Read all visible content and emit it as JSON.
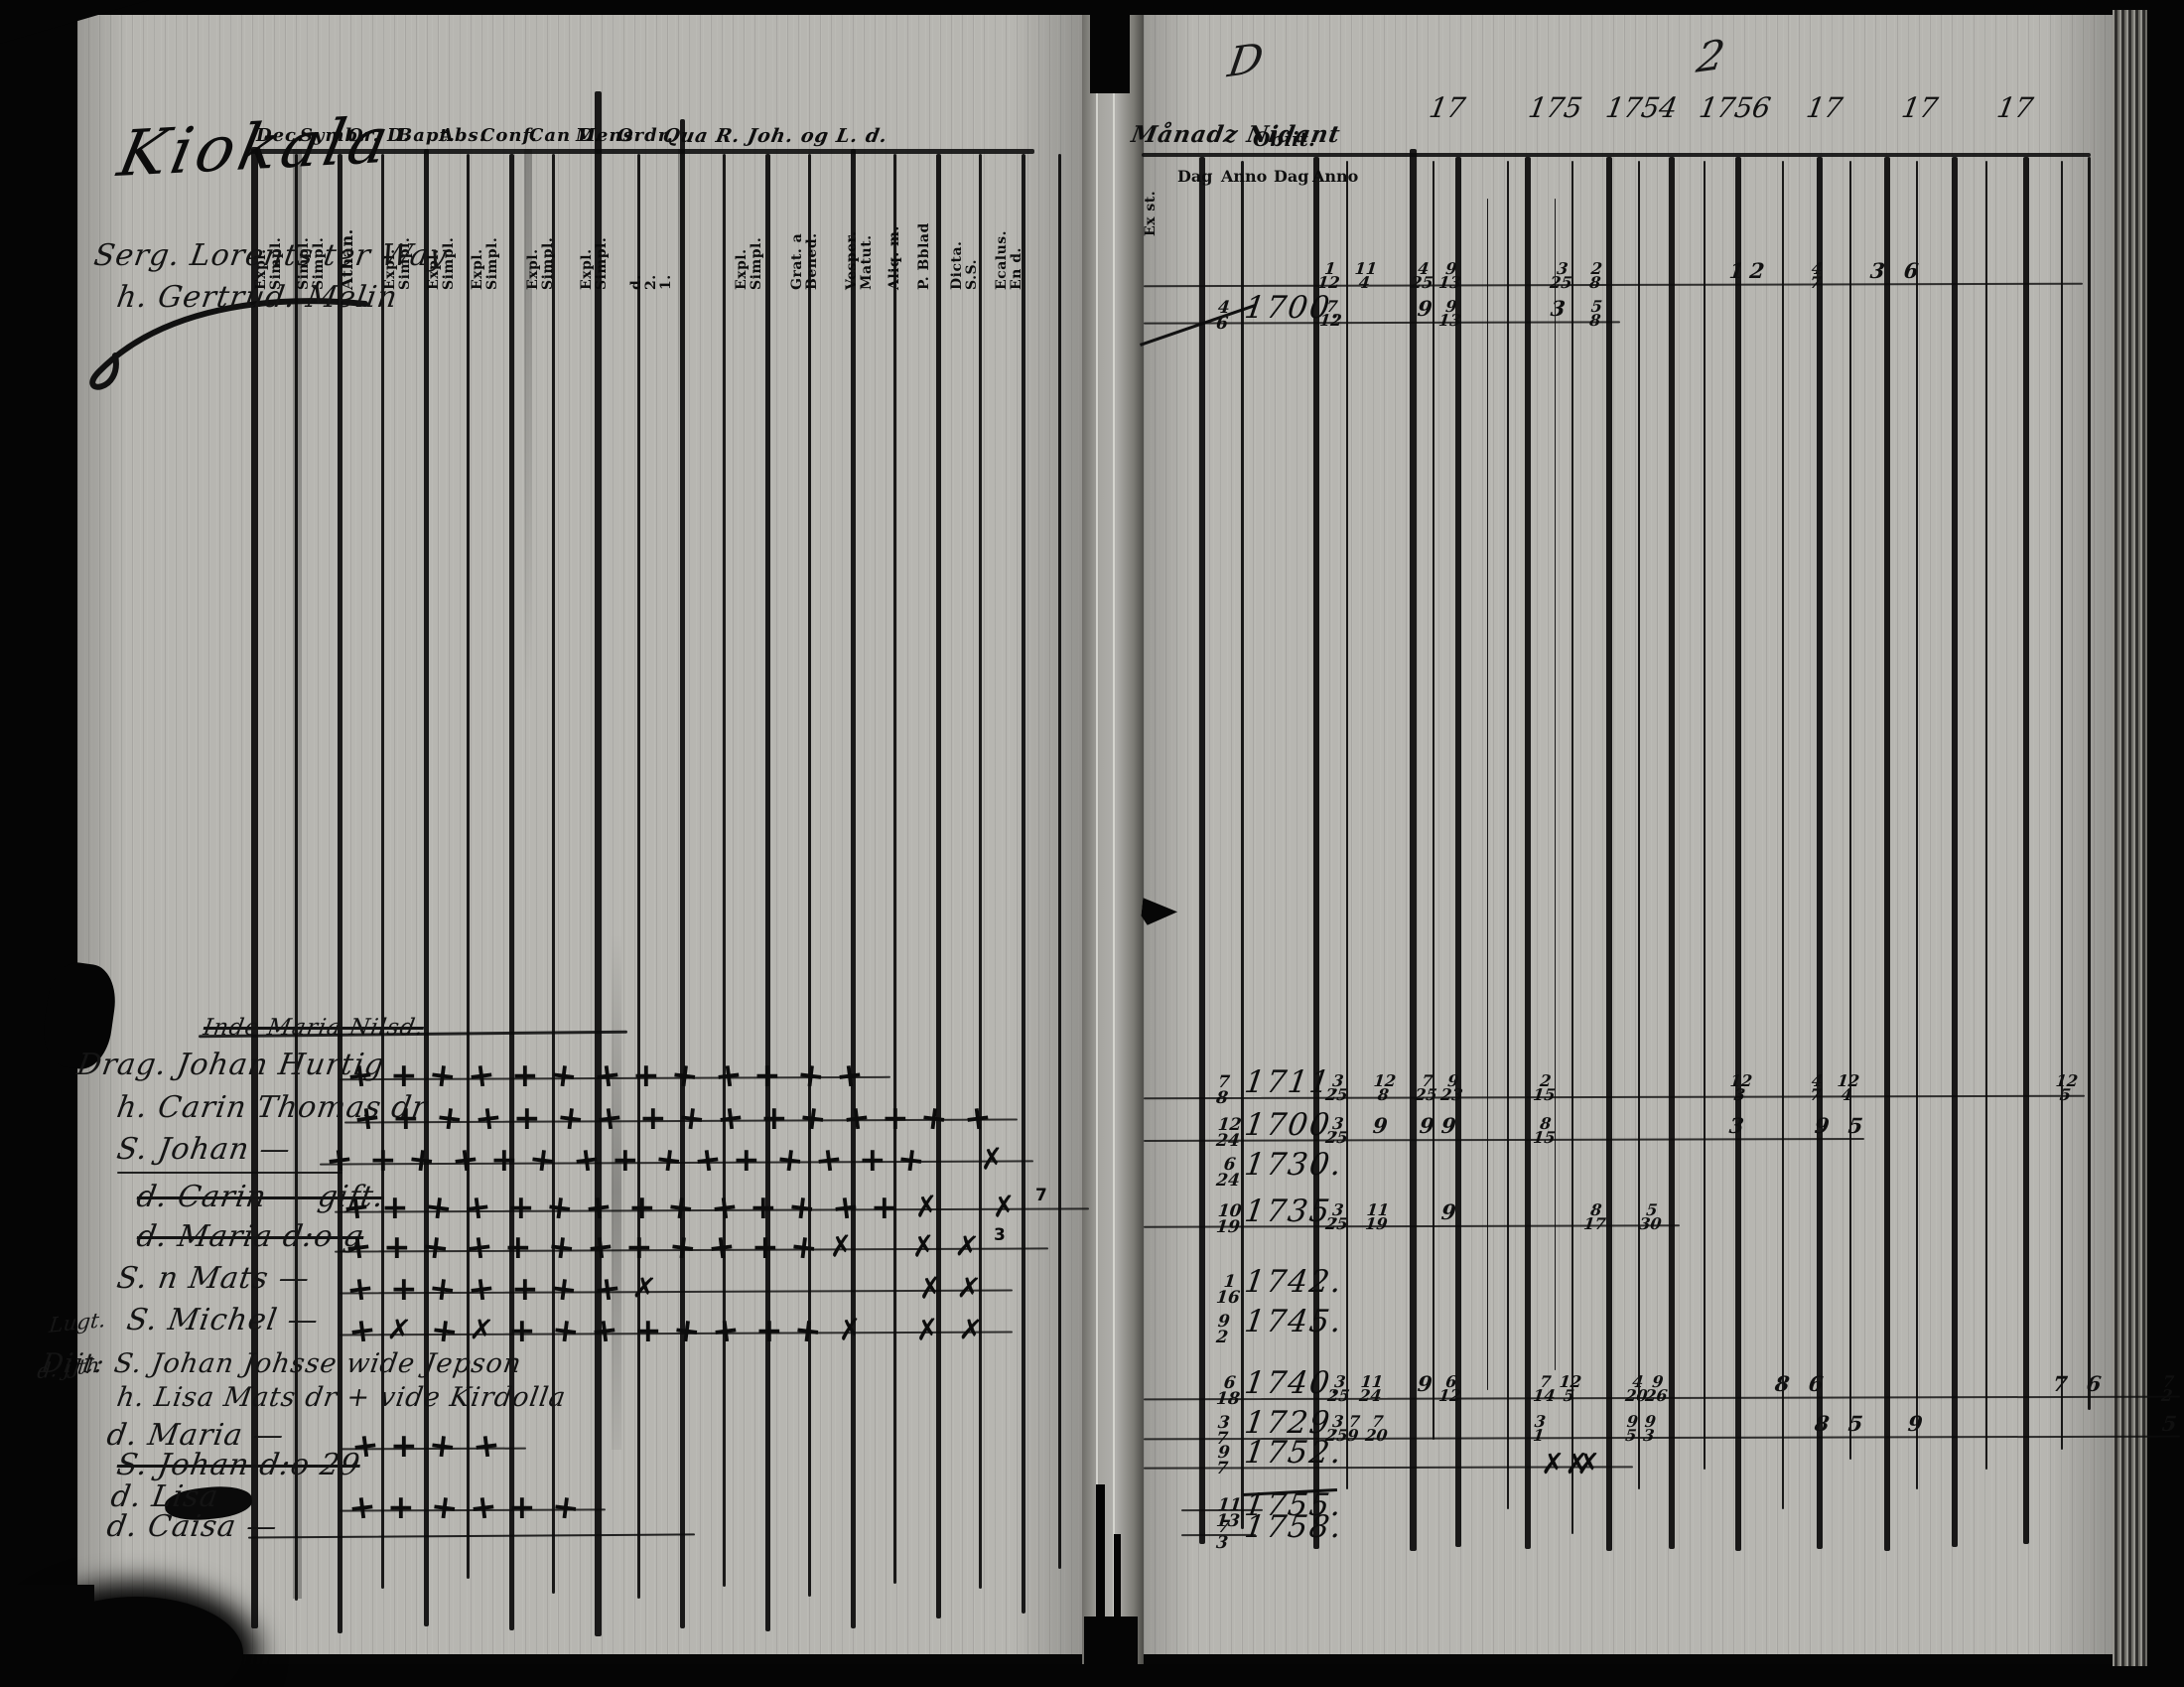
{
  "scan": {
    "left_page": {
      "title_script": "Kiokala",
      "header_terms": [
        "Dec.",
        "Symb.",
        "Or. D.",
        "Bapt.",
        "Abs.",
        "Conf.",
        "Can D.",
        "Mens.",
        "Ordr.",
        "Qua R. Joh. og L. d."
      ],
      "column_labels": [
        [
          "Expl.",
          "Simpl."
        ],
        [
          "Simpl.",
          "Simpl."
        ],
        [
          "Athan."
        ],
        [
          "Expl.",
          "Simpl."
        ],
        [
          "Expl.",
          "Simpl."
        ],
        [
          "Expl.",
          "Simpl."
        ],
        [
          "Expl.",
          "Simpl."
        ],
        [
          "Expl.",
          "Simpl."
        ],
        [
          "d.",
          "2.",
          "1."
        ],
        [
          "Expl.",
          "Simpl."
        ],
        [
          "Grat. a",
          "Bened."
        ],
        [
          "Vesper.",
          "Matut."
        ],
        [
          "Aliq. m."
        ],
        [
          "P. Bblad"
        ],
        [
          "Dicta.",
          "S.S."
        ],
        [
          "Ecalus.",
          "En d."
        ]
      ],
      "entries": [
        {
          "name": "Serg. Lorents ter Way",
          "marks": ""
        },
        {
          "name": "h. Gertrud. Melin",
          "marks": ""
        },
        {
          "name": "Inde Maria Nilsd.",
          "struck": true,
          "marks": ""
        },
        {
          "name": "Drag. Johan Hurtig",
          "marks": "+++++++++++++"
        },
        {
          "name": "h. Carin Thomas dr",
          "marks": "++++++++++++++++"
        },
        {
          "name": "S. Johan —",
          "underline": true,
          "marks": "+++++++++++++++ x"
        },
        {
          "name": "d. Carin — gift.",
          "struck": true,
          "marks": "++++++++++++++x x7"
        },
        {
          "name": "d. Maria d:o g",
          "struck": true,
          "marks": "++++++++++++x xx3"
        },
        {
          "name": "S. n Mats —",
          "marks": "+++++++x      xx"
        },
        {
          "name": "S. Michel —",
          "margin": "Lugt.",
          "marks": "+x+x++++++++x xx"
        },
        {
          "name": "Dijt: S. Johan Johsse wide Jepson",
          "margin": "d. j th",
          "marks": ""
        },
        {
          "name": "h. Lisa Mats dr + vide Kirdolla",
          "marks": ""
        },
        {
          "name": "d. Maria —",
          "marks": "++++"
        },
        {
          "name": "S. Johan d:o 29",
          "struck": true,
          "marks": ""
        },
        {
          "name": "d. Lisa",
          "marks": "++++++"
        },
        {
          "name": "d. Caisa —",
          "marks": ""
        }
      ]
    },
    "right_page": {
      "header_script": "Månadz Nidant",
      "obiit_label": "Obiit.",
      "exst_label": "Ex st.",
      "dag_anno": [
        "Dag",
        "Anno",
        "Dag",
        "Anno"
      ],
      "year_heads": [
        "17",
        "175",
        "1754",
        "1756",
        "17",
        "17",
        "17"
      ],
      "doodles": [
        "D",
        "2"
      ],
      "rows": [
        {
          "day": "",
          "year": "",
          "cells": [
            "1/12",
            "11/4",
            "4/25",
            "9/13",
            "3/25",
            "2/8",
            "12",
            "4/7",
            "3 6"
          ]
        },
        {
          "day": "4/6",
          "year": "1700.",
          "cells": [
            "7/12",
            "9",
            "9/13",
            "3",
            "5/8"
          ]
        },
        {
          "day": "7/8",
          "year": "1711.",
          "cells": [
            "3/25",
            "12/8",
            "7/25",
            "9/23",
            "2/15",
            "12/3",
            "4/7",
            "12/4",
            "12/5"
          ]
        },
        {
          "day": "12/24",
          "year": "1700.",
          "cells": [
            "3/25",
            "9",
            "9",
            "9",
            "8/15",
            "3",
            "9 5"
          ]
        },
        {
          "day": "6/24",
          "year": "1730.",
          "cells": []
        },
        {
          "day": "10/19",
          "year": "1735.",
          "cells": [
            "3/25",
            "11/19",
            "9",
            "8/17",
            "5/30"
          ]
        },
        {
          "day": "1/16",
          "year": "1742.",
          "cells": []
        },
        {
          "day": "9/2",
          "year": "1745.",
          "cells": []
        },
        {
          "day": "6/18",
          "year": "1740.",
          "cells": [
            "3/25",
            "11/24",
            "9",
            "6/12",
            "7/14",
            "12/5",
            "4/20",
            "9/26",
            "8 6",
            "7 6",
            "7/2"
          ]
        },
        {
          "day": "3/7",
          "year": "1729.",
          "cells": [
            "3/25",
            "7/9",
            "7/20",
            "3/1",
            "9/5",
            "9/3",
            "8 5",
            "9",
            "5"
          ]
        },
        {
          "day": "9/7",
          "year": "1752.",
          "cells": [
            "xx",
            "x"
          ]
        },
        {
          "day": "11/13",
          "year": "1755.",
          "cells": []
        },
        {
          "day": "7/3",
          "year": "1758.",
          "cells": []
        }
      ]
    }
  }
}
